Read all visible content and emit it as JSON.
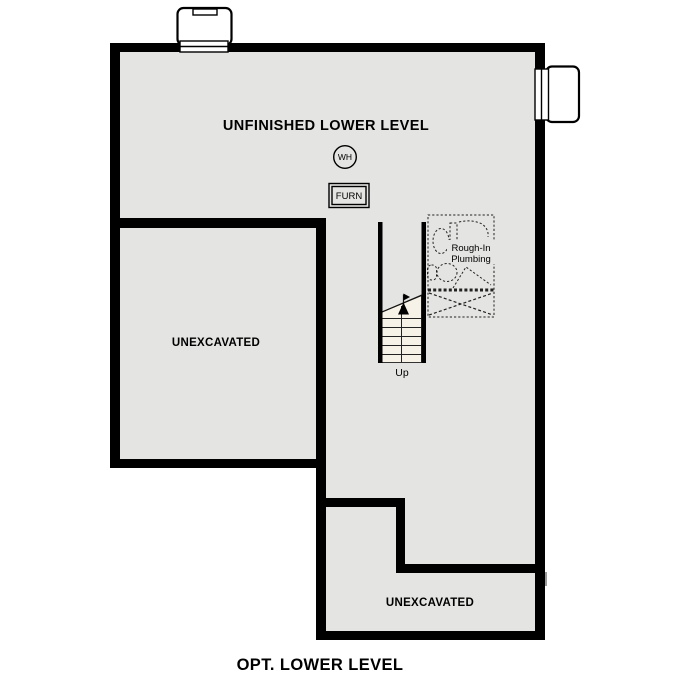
{
  "caption": "OPT. LOWER LEVEL",
  "rooms": {
    "main_label": "UNFINISHED LOWER LEVEL",
    "left_unexcavated_label": "UNEXCAVATED",
    "bottom_unexcavated_label": "UNEXCAVATED"
  },
  "fixtures": {
    "water_heater_label": "WH",
    "furnace_label": "FURN",
    "plumbing_label_line1": "Rough-In",
    "plumbing_label_line2": "Plumbing"
  },
  "stairs": {
    "direction_label": "Up"
  },
  "colors": {
    "wall": "#000000",
    "floor": "#e4e4e2",
    "stair": "#f7f2e7",
    "background": "#ffffff",
    "text": "#000000"
  }
}
